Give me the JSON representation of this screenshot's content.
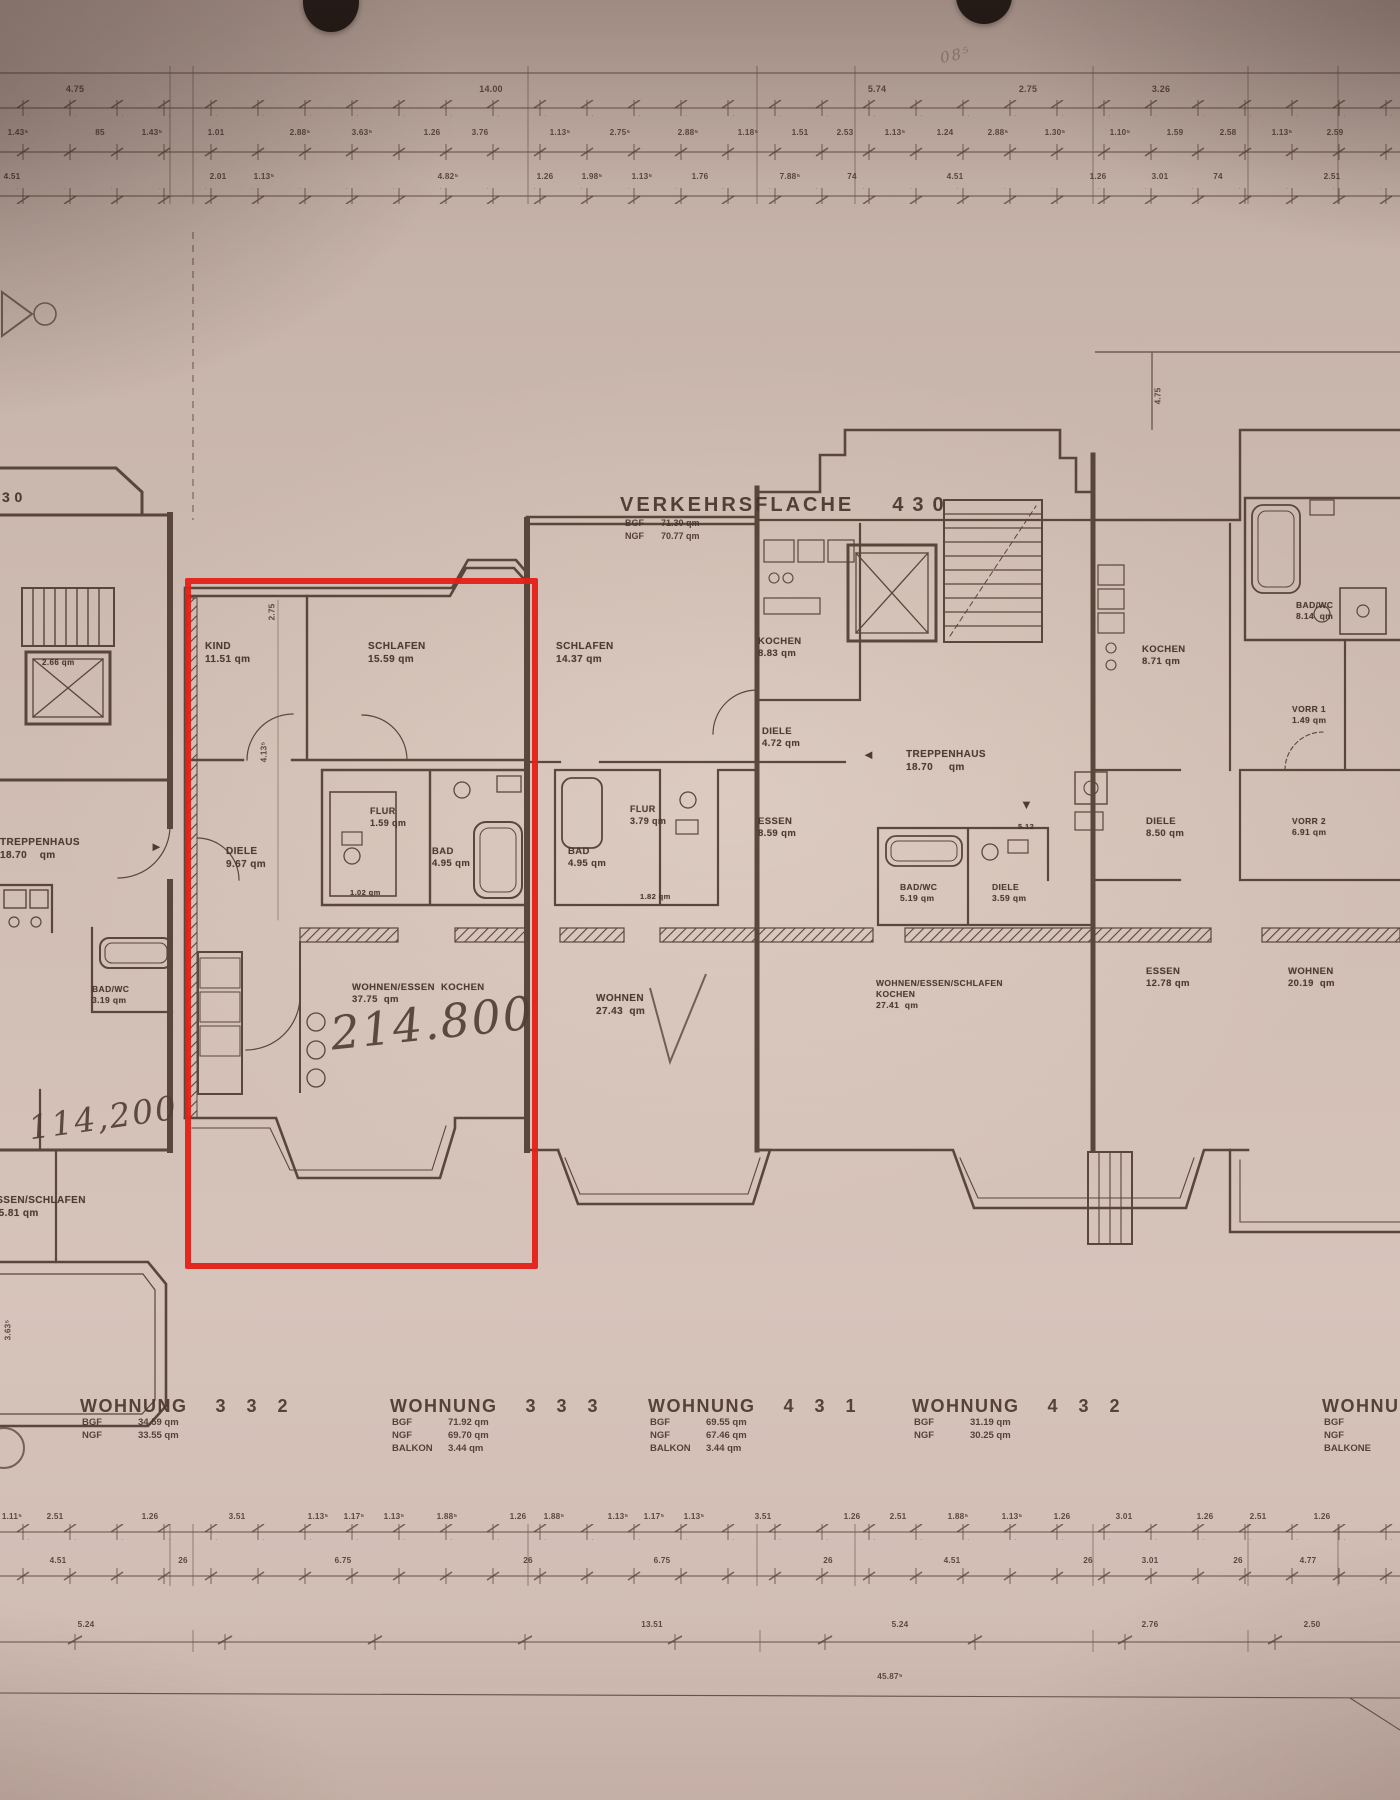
{
  "highlight": {
    "color": "#e42017"
  },
  "plan": {
    "verkehrsflaeche": {
      "label": "VERKEHRSFLACHE",
      "number": "430",
      "rows": [
        [
          "BGF",
          "71.30  qm"
        ],
        [
          "NGF",
          "70.77  qm"
        ]
      ]
    },
    "room_labels": [
      {
        "name": "building-number-partial",
        "x": 2,
        "y": 488,
        "size": 14,
        "lines": [
          "3 0"
        ]
      },
      {
        "name": "room-kind",
        "x": 205,
        "y": 640,
        "lines": [
          "KIND",
          "11.51 qm"
        ]
      },
      {
        "name": "room-schlafen-333",
        "x": 368,
        "y": 640,
        "lines": [
          "SCHLAFEN",
          "15.59 qm"
        ]
      },
      {
        "name": "room-diele-333",
        "x": 226,
        "y": 845,
        "lines": [
          "DIELE",
          "9.67 qm"
        ]
      },
      {
        "name": "room-flur-333",
        "x": 370,
        "y": 806,
        "size": 9,
        "lines": [
          "FLUR",
          "1.59 qm"
        ]
      },
      {
        "name": "room-wc-333",
        "x": 350,
        "y": 888,
        "size": 7.5,
        "lines": [
          "1.02 qm"
        ]
      },
      {
        "name": "room-bad-333",
        "x": 432,
        "y": 846,
        "size": 9.5,
        "lines": [
          "BAD",
          "4.95 qm"
        ]
      },
      {
        "name": "room-wohnen-essen-333",
        "x": 352,
        "y": 982,
        "size": 9.5,
        "lines": [
          "WOHNEN/ESSEN  KOCHEN",
          "37.75  qm"
        ]
      },
      {
        "name": "room-treppenhaus-332",
        "x": 0,
        "y": 836,
        "lines": [
          "TREPPENHAUS",
          "18.70    qm"
        ]
      },
      {
        "name": "room-aufzug-332",
        "x": 42,
        "y": 658,
        "size": 8,
        "lines": [
          "2.66 qm"
        ]
      },
      {
        "name": "room-badwc-332",
        "x": 92,
        "y": 984,
        "size": 8.5,
        "lines": [
          "BAD/WC",
          "3.19 qm"
        ]
      },
      {
        "name": "room-wohnen-332",
        "x": -62,
        "y": 1194,
        "lines": [
          "WOHNEN/ESSEN/SCHLAFEN",
          "KÜCHEN   25.81 qm"
        ]
      },
      {
        "name": "room-schlafen-431",
        "x": 556,
        "y": 640,
        "lines": [
          "SCHLAFEN",
          "14.37 qm"
        ]
      },
      {
        "name": "room-flur-431",
        "x": 630,
        "y": 804,
        "size": 9,
        "lines": [
          "FLUR",
          "3.79 qm"
        ]
      },
      {
        "name": "room-bad-431",
        "x": 568,
        "y": 846,
        "size": 9.5,
        "lines": [
          "BAD",
          "4.95 qm"
        ]
      },
      {
        "name": "room-wc-431",
        "x": 640,
        "y": 892,
        "size": 7.5,
        "lines": [
          "1.82 qm"
        ]
      },
      {
        "name": "room-wohnen-431",
        "x": 596,
        "y": 992,
        "lines": [
          "WOHNEN",
          "27.43  qm"
        ]
      },
      {
        "name": "room-kochen-430",
        "x": 758,
        "y": 636,
        "size": 9.5,
        "lines": [
          "KOCHEN",
          "8.83 qm"
        ]
      },
      {
        "name": "room-diele-430",
        "x": 762,
        "y": 726,
        "size": 9.5,
        "lines": [
          "DIELE",
          "4.72 qm"
        ]
      },
      {
        "name": "room-essen-430",
        "x": 758,
        "y": 816,
        "size": 9.5,
        "lines": [
          "ESSEN",
          "8.59 qm"
        ]
      },
      {
        "name": "room-treppenhaus-430",
        "x": 906,
        "y": 748,
        "lines": [
          "TREPPENHAUS",
          "18.70     qm"
        ]
      },
      {
        "name": "room-badwc-430",
        "x": 900,
        "y": 882,
        "size": 8.5,
        "lines": [
          "BAD/WC",
          "5.19 qm"
        ]
      },
      {
        "name": "room-diele2-430",
        "x": 992,
        "y": 882,
        "size": 8.5,
        "lines": [
          "DIELE",
          "3.59 qm"
        ]
      },
      {
        "name": "room-wohnen-432",
        "x": 876,
        "y": 978,
        "size": 8.5,
        "lines": [
          "WOHNEN/ESSEN/SCHLAFEN",
          "KOCHEN",
          "27.41  qm"
        ]
      },
      {
        "name": "room-dim-512",
        "x": 1018,
        "y": 822,
        "size": 7.5,
        "lines": [
          "5.12"
        ]
      },
      {
        "name": "room-kochen-right",
        "x": 1142,
        "y": 644,
        "size": 9.5,
        "lines": [
          "KOCHEN",
          "8.71 qm"
        ]
      },
      {
        "name": "room-badwc-right",
        "x": 1296,
        "y": 600,
        "size": 8.5,
        "lines": [
          "BAD/WC",
          "8.14  qm"
        ]
      },
      {
        "name": "room-vorr1-right",
        "x": 1292,
        "y": 704,
        "size": 8.5,
        "lines": [
          "VORR 1",
          "1.49 qm"
        ]
      },
      {
        "name": "room-diele-right",
        "x": 1146,
        "y": 816,
        "size": 9.5,
        "lines": [
          "DIELE",
          "8.50 qm"
        ]
      },
      {
        "name": "room-vorr2-right",
        "x": 1292,
        "y": 816,
        "size": 8.5,
        "lines": [
          "VORR 2",
          "6.91 qm"
        ]
      },
      {
        "name": "room-essen-right",
        "x": 1146,
        "y": 966,
        "size": 9.5,
        "lines": [
          "ESSEN",
          "12.78 qm"
        ]
      },
      {
        "name": "room-wohnen-right",
        "x": 1288,
        "y": 966,
        "size": 9.5,
        "lines": [
          "WOHNEN",
          "20.19  qm"
        ]
      }
    ],
    "markers": [
      {
        "name": "arrow-right-marker",
        "glyph": "►",
        "x": 150,
        "y": 840
      },
      {
        "name": "arrow-left-marker",
        "glyph": "◄",
        "x": 862,
        "y": 748
      },
      {
        "name": "arrow-down-marker",
        "glyph": "▼",
        "x": 1020,
        "y": 798
      }
    ],
    "hand_notes": [
      {
        "name": "handwritten-price-214800",
        "text": "214.800",
        "x": 330,
        "y": 996,
        "size": 46,
        "rot": -6
      },
      {
        "name": "handwritten-price-114200",
        "text": "114,200",
        "x": 28,
        "y": 1098,
        "size": 33,
        "rot": -8
      },
      {
        "name": "handwritten-note-top",
        "text": "08⁵",
        "x": 940,
        "y": 46,
        "size": 15,
        "rot": -12,
        "opacity": 0.45
      }
    ]
  },
  "dimensions": {
    "rows": [
      {
        "name": "dim-row-top-1",
        "y": 84,
        "size": 9,
        "items": [
          {
            "x": 75,
            "t": "4.75"
          },
          {
            "x": 491,
            "t": "14.00"
          },
          {
            "x": 877,
            "t": "5.74"
          },
          {
            "x": 1028,
            "t": "2.75"
          },
          {
            "x": 1161,
            "t": "3.26"
          }
        ]
      },
      {
        "name": "dim-row-top-2",
        "y": 128,
        "items": [
          {
            "x": 18,
            "t": "1.43⁵"
          },
          {
            "x": 100,
            "t": "85"
          },
          {
            "x": 152,
            "t": "1.43⁵"
          },
          {
            "x": 216,
            "t": "1.01"
          },
          {
            "x": 300,
            "t": "2.88⁵"
          },
          {
            "x": 362,
            "t": "3.63⁵"
          },
          {
            "x": 432,
            "t": "1.26"
          },
          {
            "x": 480,
            "t": "3.76"
          },
          {
            "x": 560,
            "t": "1.13⁵"
          },
          {
            "x": 620,
            "t": "2.75⁵"
          },
          {
            "x": 688,
            "t": "2.88⁵"
          },
          {
            "x": 748,
            "t": "1.18⁵"
          },
          {
            "x": 800,
            "t": "1.51"
          },
          {
            "x": 845,
            "t": "2.53"
          },
          {
            "x": 895,
            "t": "1.13⁵"
          },
          {
            "x": 945,
            "t": "1.24"
          },
          {
            "x": 998,
            "t": "2.88⁵"
          },
          {
            "x": 1055,
            "t": "1.30⁵"
          },
          {
            "x": 1120,
            "t": "1.10⁵"
          },
          {
            "x": 1175,
            "t": "1.59"
          },
          {
            "x": 1228,
            "t": "2.58"
          },
          {
            "x": 1282,
            "t": "1.13⁵"
          },
          {
            "x": 1335,
            "t": "2.59"
          }
        ]
      },
      {
        "name": "dim-row-top-3",
        "y": 172,
        "items": [
          {
            "x": 12,
            "t": "4.51"
          },
          {
            "x": 218,
            "t": "2.01"
          },
          {
            "x": 264,
            "t": "1.13⁵"
          },
          {
            "x": 448,
            "t": "4.82⁵"
          },
          {
            "x": 545,
            "t": "1.26"
          },
          {
            "x": 592,
            "t": "1.98⁵"
          },
          {
            "x": 642,
            "t": "1.13⁵"
          },
          {
            "x": 700,
            "t": "1.76"
          },
          {
            "x": 790,
            "t": "7.88⁵"
          },
          {
            "x": 852,
            "t": "74"
          },
          {
            "x": 955,
            "t": "4.51"
          },
          {
            "x": 1098,
            "t": "1.26"
          },
          {
            "x": 1160,
            "t": "3.01"
          },
          {
            "x": 1218,
            "t": "74"
          },
          {
            "x": 1332,
            "t": "2.51"
          }
        ]
      },
      {
        "name": "dim-row-bottom-1",
        "y": 1512,
        "items": [
          {
            "x": 12,
            "t": "1.11⁵"
          },
          {
            "x": 55,
            "t": "2.51"
          },
          {
            "x": 150,
            "t": "1.26"
          },
          {
            "x": 237,
            "t": "3.51"
          },
          {
            "x": 318,
            "t": "1.13⁵"
          },
          {
            "x": 354,
            "t": "1.17⁵"
          },
          {
            "x": 394,
            "t": "1.13⁵"
          },
          {
            "x": 447,
            "t": "1.88⁵"
          },
          {
            "x": 518,
            "t": "1.26"
          },
          {
            "x": 554,
            "t": "1.88⁵"
          },
          {
            "x": 618,
            "t": "1.13⁵"
          },
          {
            "x": 654,
            "t": "1.17⁵"
          },
          {
            "x": 694,
            "t": "1.13⁵"
          },
          {
            "x": 763,
            "t": "3.51"
          },
          {
            "x": 852,
            "t": "1.26"
          },
          {
            "x": 898,
            "t": "2.51"
          },
          {
            "x": 958,
            "t": "1.88⁵"
          },
          {
            "x": 1012,
            "t": "1.13⁵"
          },
          {
            "x": 1062,
            "t": "1.26"
          },
          {
            "x": 1124,
            "t": "3.01"
          },
          {
            "x": 1205,
            "t": "1.26"
          },
          {
            "x": 1258,
            "t": "2.51"
          },
          {
            "x": 1322,
            "t": "1.26"
          }
        ]
      },
      {
        "name": "dim-row-bottom-2",
        "y": 1556,
        "items": [
          {
            "x": 58,
            "t": "4.51"
          },
          {
            "x": 183,
            "t": "26"
          },
          {
            "x": 343,
            "t": "6.75"
          },
          {
            "x": 528,
            "t": "26"
          },
          {
            "x": 662,
            "t": "6.75"
          },
          {
            "x": 828,
            "t": "26"
          },
          {
            "x": 952,
            "t": "4.51"
          },
          {
            "x": 1088,
            "t": "26"
          },
          {
            "x": 1150,
            "t": "3.01"
          },
          {
            "x": 1238,
            "t": "26"
          },
          {
            "x": 1308,
            "t": "4.77"
          }
        ]
      },
      {
        "name": "dim-row-bottom-3",
        "y": 1620,
        "items": [
          {
            "x": 86,
            "t": "5.24"
          },
          {
            "x": 652,
            "t": "13.51"
          },
          {
            "x": 900,
            "t": "5.24"
          },
          {
            "x": 1150,
            "t": "2.76"
          },
          {
            "x": 1312,
            "t": "2.50"
          }
        ]
      },
      {
        "name": "dim-row-bottom-total",
        "y": 1672,
        "items": [
          {
            "x": 890,
            "t": "45.87⁵"
          }
        ]
      }
    ],
    "vertical": [
      {
        "x": 272,
        "y": 612,
        "t": "2.75"
      },
      {
        "x": 264,
        "y": 752,
        "t": "4.13⁵"
      },
      {
        "x": 1158,
        "y": 396,
        "t": "4.75"
      },
      {
        "x": 8,
        "y": 1330,
        "t": "3.63⁵"
      }
    ]
  },
  "apartments": {
    "blocks": [
      {
        "x": 80,
        "title": "WOHNUNG",
        "number": "3 3 2",
        "rows": [
          [
            "BGF",
            "34.59 qm"
          ],
          [
            "NGF",
            "33.55 qm"
          ]
        ]
      },
      {
        "x": 390,
        "title": "WOHNUNG",
        "number": "3 3 3",
        "rows": [
          [
            "BGF",
            "71.92  qm"
          ],
          [
            "NGF",
            "69.70  qm"
          ],
          [
            "BALKON",
            "3.44  qm"
          ]
        ]
      },
      {
        "x": 648,
        "title": "WOHNUNG",
        "number": "4 3 1",
        "rows": [
          [
            "BGF",
            "69.55  qm"
          ],
          [
            "NGF",
            "67.46  qm"
          ],
          [
            "BALKON",
            "3.44  qm"
          ]
        ]
      },
      {
        "x": 912,
        "title": "WOHNUNG",
        "number": "4 3 2",
        "rows": [
          [
            "BGF",
            "31.19  qm"
          ],
          [
            "NGF",
            "30.25  qm"
          ]
        ]
      },
      {
        "x": 1322,
        "title": "WOHNUNG",
        "number": "",
        "rows": [
          [
            "BGF",
            ""
          ],
          [
            "NGF",
            ""
          ],
          [
            "BALKONE",
            ""
          ]
        ]
      }
    ]
  }
}
